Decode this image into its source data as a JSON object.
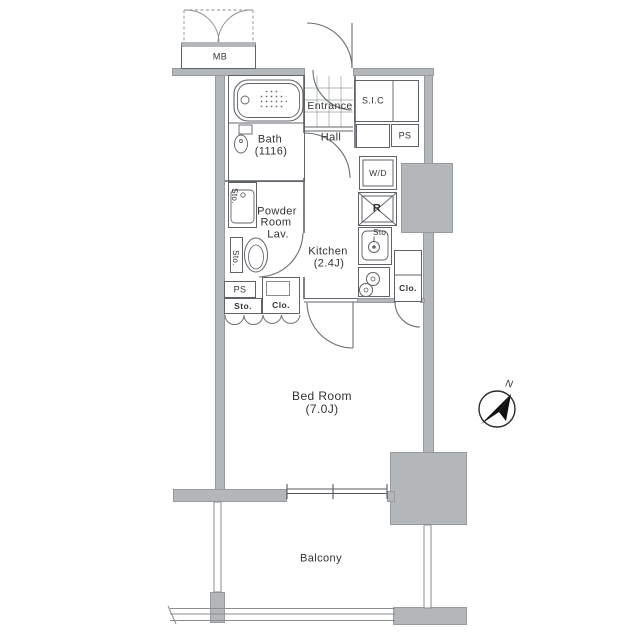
{
  "labels": {
    "mb": "MB",
    "entrance": "Entrance",
    "hall": "Hall",
    "sic": "S.I.C",
    "ps_upper": "PS",
    "wd": "W/D",
    "fridge": "R",
    "bath_name": "Bath",
    "bath_size": "(1116)",
    "powder_line1": "Powder",
    "powder_line2": "Room",
    "powder_line3": "Lav.",
    "kitchen_name": "Kitchen",
    "kitchen_size": "(2.4J)",
    "sink_sto": "Sto.",
    "vanity_sto": "Sto.",
    "toilet_sto": "Sto.",
    "ps_lower": "PS",
    "sto_lower": "Sto.",
    "clo_left": "Clo.",
    "clo_right": "Clo.",
    "bedroom_name": "Bed Room",
    "bedroom_size": "(7.0J)",
    "balcony": "Balcony",
    "north": "N"
  },
  "colors": {
    "wall": "#b4b7ba",
    "wallEdge": "#989b9e",
    "line": "#5f6368",
    "text": "#333333"
  }
}
